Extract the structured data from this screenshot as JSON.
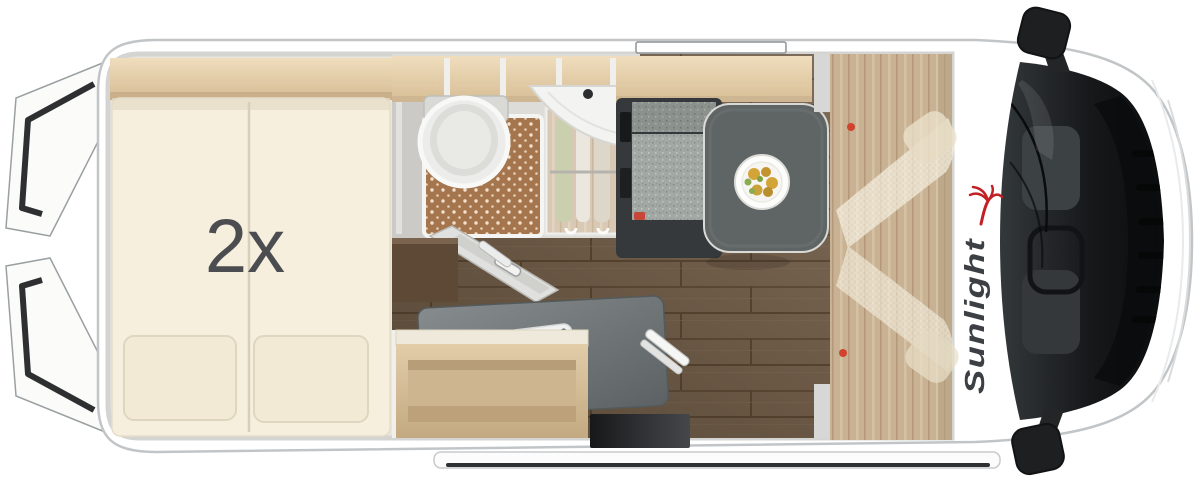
{
  "labels": {
    "bed_quantity": "2x",
    "brand_name": "Sunlight"
  },
  "icons": {
    "brand_logo": "palm-tree-icon"
  },
  "furniture": [
    "rear-double-bed",
    "pillows",
    "overhead-storage-lockers",
    "toilet",
    "shower-tray",
    "corner-washbasin",
    "wardrobe-with-clothes",
    "bathroom-door",
    "kitchen-counter",
    "two-burner-hob",
    "kitchen-sink",
    "kitchen-faucet",
    "kitchen-shelf",
    "dinette-bench",
    "dinette-table",
    "plate-of-food",
    "swivel-cab-seats",
    "driver-cab",
    "steering-wheel",
    "windshield",
    "side-mirrors",
    "rear-doors-open",
    "entry-step",
    "roof-window"
  ],
  "colors": {
    "brand_red": "#c32026",
    "brand_text": "#3c3f44",
    "bed_label": "#4b4d51",
    "bed_cream": "#f6efde",
    "pillow_cream": "#f3ead6",
    "wood_light": "#e6d2ae",
    "floor_dark_wood": "#75614d",
    "counter_gray": "#767c7d",
    "table_gray": "#5f6564",
    "bench_cushion": "#a2a8a3",
    "shower_terracotta": "#a5764e",
    "cab_wood_tan": "#c9b294",
    "glass_dark": "#1a1d1f",
    "van_outline": "#c2c5c7"
  }
}
